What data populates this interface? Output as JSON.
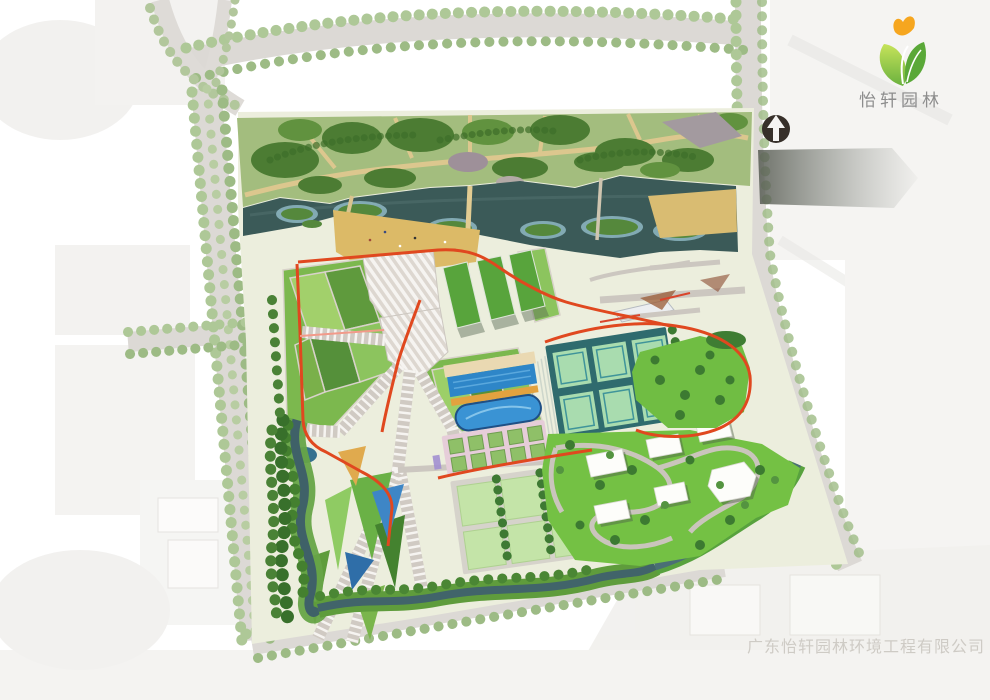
{
  "branding": {
    "logo_text": "怡轩园林",
    "logo_text_color": "#8d8d8d",
    "logo_icon": "sprout-butterfly-logo-icon",
    "logo_leaf_colors": [
      "#c6e35a",
      "#6ab13e",
      "#5aa838"
    ],
    "logo_butterfly_color": "#f6a61f"
  },
  "compass": {
    "icon": "north-arrow-icon",
    "background_color": "#37302a",
    "arrow_color": "#f5f4f2"
  },
  "watermark": {
    "text": "广东怡轩园林环境工程有限公司",
    "color": "#cdc9c3"
  },
  "plan": {
    "type": "landscape-masterplan-aerial-rendering",
    "features": [
      {
        "name": "north-woodland-park",
        "color": "#4c7c33"
      },
      {
        "name": "riverside-tan-paths",
        "color": "#dcc78e"
      },
      {
        "name": "river",
        "color": "#3b5a58"
      },
      {
        "name": "wetland-islands",
        "color": "#55883c"
      },
      {
        "name": "sand-beach",
        "color": "#dcba67"
      },
      {
        "name": "terraced-lawn-fields",
        "color": "#7cb84e"
      },
      {
        "name": "green-roof-buildings",
        "color": "#58a43c"
      },
      {
        "name": "striped-plaza-ramps",
        "color": "#ddd7d0"
      },
      {
        "name": "red-jogging-loop",
        "color": "#e0481f"
      },
      {
        "name": "tennis-court-cluster",
        "color": "#2f6b6e"
      },
      {
        "name": "swimming-pool-complex",
        "color": "#2e86c8"
      },
      {
        "name": "pink-event-plaza",
        "color": "#e6cdd9"
      },
      {
        "name": "nursery-plots",
        "color": "#c4e4a8"
      },
      {
        "name": "event-lawn-white-canopies",
        "color": "#74c144"
      },
      {
        "name": "winding-streams",
        "color": "#46686e"
      },
      {
        "name": "street-tree-boulevards",
        "color": "#aec897"
      },
      {
        "name": "faded-city-context",
        "color": "#f1f0ee"
      },
      {
        "name": "overpass-bridge",
        "color": "#575c53"
      }
    ]
  }
}
